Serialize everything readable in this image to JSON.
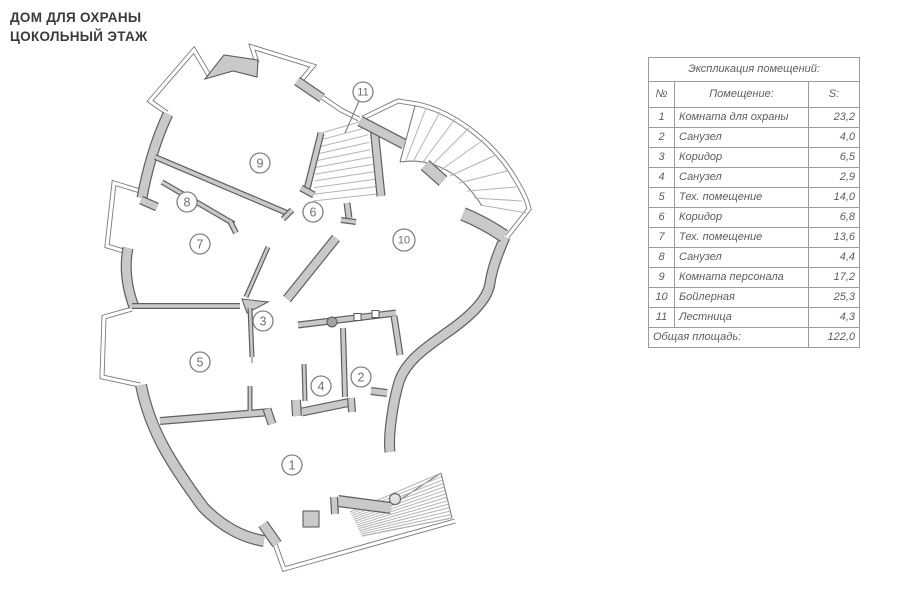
{
  "page_title": {
    "line1": "ДОМ ДЛЯ ОХРАНЫ",
    "line2": "ЦОКОЛЬНЫЙ ЭТАЖ"
  },
  "legend": {
    "title": "Экспликация помещений:",
    "columns": {
      "num": "№",
      "name": "Помещение:",
      "area": "S:"
    },
    "rows": [
      {
        "num": "1",
        "name": "Комната для охраны",
        "area": "23,2"
      },
      {
        "num": "2",
        "name": "Санузел",
        "area": "4,0"
      },
      {
        "num": "3",
        "name": "Коридор",
        "area": "6,5"
      },
      {
        "num": "4",
        "name": "Санузел",
        "area": "2,9"
      },
      {
        "num": "5",
        "name": "Тех. помещение",
        "area": "14,0"
      },
      {
        "num": "6",
        "name": "Коридор",
        "area": "6,8"
      },
      {
        "num": "7",
        "name": "Тех. помещение",
        "area": "13,6"
      },
      {
        "num": "8",
        "name": "Санузел",
        "area": "4,4"
      },
      {
        "num": "9",
        "name": "Комната персонала",
        "area": "17,2"
      },
      {
        "num": "10",
        "name": "Бойлерная",
        "area": "25,3"
      },
      {
        "num": "11",
        "name": "Лестница",
        "area": "4,3"
      }
    ],
    "total_label": "Общая площадь:",
    "total_value": "122,0"
  },
  "plan": {
    "rooms": [
      {
        "id": "1",
        "x": 292,
        "y": 465,
        "r": 10
      },
      {
        "id": "2",
        "x": 361,
        "y": 377,
        "r": 10
      },
      {
        "id": "3",
        "x": 263,
        "y": 321,
        "r": 10
      },
      {
        "id": "4",
        "x": 321,
        "y": 386,
        "r": 10
      },
      {
        "id": "5",
        "x": 200,
        "y": 362,
        "r": 10
      },
      {
        "id": "6",
        "x": 313,
        "y": 212,
        "r": 10
      },
      {
        "id": "7",
        "x": 200,
        "y": 244,
        "r": 10
      },
      {
        "id": "8",
        "x": 187,
        "y": 202,
        "r": 10
      },
      {
        "id": "9",
        "x": 260,
        "y": 163,
        "r": 10
      },
      {
        "id": "10",
        "x": 404,
        "y": 240,
        "r": 11
      },
      {
        "id": "11",
        "x": 363,
        "y": 92,
        "r": 10
      }
    ],
    "leader": {
      "room": "11",
      "x1": 359,
      "y1": 101,
      "x2": 345,
      "y2": 133
    }
  },
  "colors": {
    "wall_fill": "#c9c9c9",
    "wall_edge": "#5f5f5f",
    "thin_line": "#7b7b7b",
    "hatch": "#b4b4b4",
    "circle_stroke": "#808080",
    "circle_text": "#707070",
    "title_text": "#3a3a3a",
    "table_text": "#5d5d5d",
    "table_border": "#9c9c9c"
  }
}
